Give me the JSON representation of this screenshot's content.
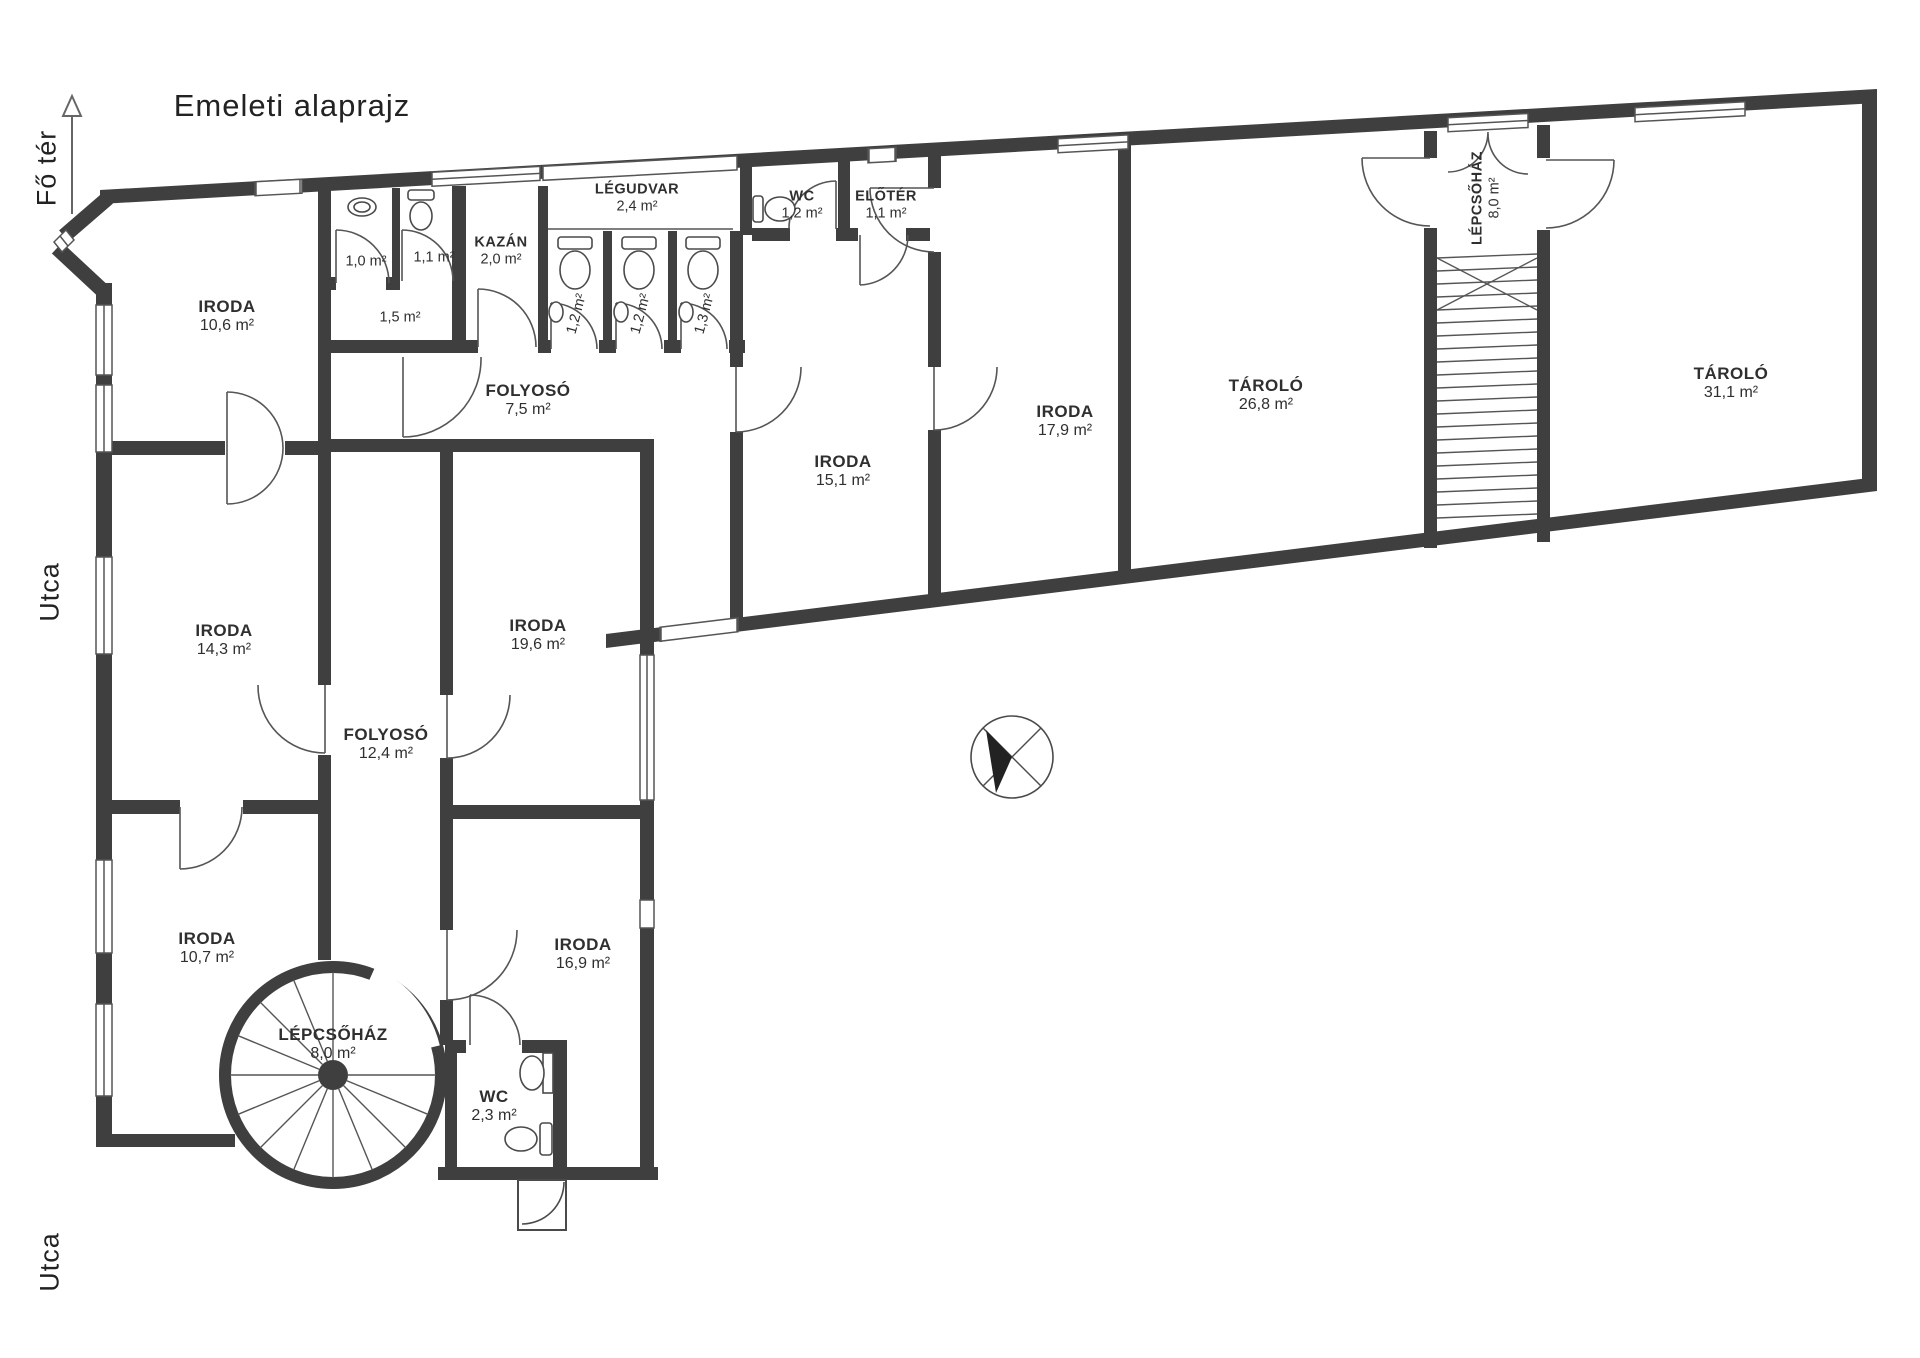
{
  "title": "Emeleti alaprajz",
  "annotations": {
    "fo_ter": "Fő tér",
    "utca_left": "Utca",
    "utca_bottom": "Utca"
  },
  "colors": {
    "wall": "#3f3f3f",
    "line": "#555555",
    "text": "#2a2a2a",
    "bg": "#ffffff"
  },
  "icons": [
    "north-compass-icon",
    "direction-arrow-icon",
    "toilet-icon",
    "sink-icon",
    "spiral-stair-icon",
    "straight-stair-icon",
    "door-swing-icon",
    "window-icon"
  ],
  "rooms": [
    {
      "name": "IRODA",
      "area": "10,6 m²",
      "x": 227,
      "y": 316,
      "rot": 0,
      "small": false
    },
    {
      "name": "",
      "area": "1,0 m²",
      "x": 366,
      "y": 262,
      "rot": 0,
      "small": true
    },
    {
      "name": "",
      "area": "1,1 m²",
      "x": 434,
      "y": 258,
      "rot": 0,
      "small": true
    },
    {
      "name": "",
      "area": "1,5 m²",
      "x": 400,
      "y": 318,
      "rot": 0,
      "small": true
    },
    {
      "name": "KAZÁN",
      "area": "2,0 m²",
      "x": 501,
      "y": 251,
      "rot": 0,
      "small": true
    },
    {
      "name": "LÉGUDVAR",
      "area": "2,4 m²",
      "x": 637,
      "y": 198,
      "rot": 0,
      "small": true
    },
    {
      "name": "WC",
      "area": "1,2 m²",
      "x": 802,
      "y": 205,
      "rot": 0,
      "small": true
    },
    {
      "name": "ELŐTÉR",
      "area": "1,1 m²",
      "x": 886,
      "y": 205,
      "rot": 0,
      "small": true
    },
    {
      "name": "",
      "area": "1,2 m²",
      "x": 577,
      "y": 314,
      "rot": -75,
      "small": true
    },
    {
      "name": "",
      "area": "1,2 m²",
      "x": 641,
      "y": 314,
      "rot": -75,
      "small": true
    },
    {
      "name": "",
      "area": "1,3 m²",
      "x": 705,
      "y": 314,
      "rot": -75,
      "small": true
    },
    {
      "name": "FOLYOSÓ",
      "area": "7,5 m²",
      "x": 528,
      "y": 400,
      "rot": 0,
      "small": false
    },
    {
      "name": "IRODA",
      "area": "15,1 m²",
      "x": 843,
      "y": 471,
      "rot": 0,
      "small": false
    },
    {
      "name": "IRODA",
      "area": "17,9 m²",
      "x": 1065,
      "y": 421,
      "rot": 0,
      "small": false
    },
    {
      "name": "TÁROLÓ",
      "area": "26,8 m²",
      "x": 1266,
      "y": 395,
      "rot": 0,
      "small": false
    },
    {
      "name": "LÉPCSŐHÁZ",
      "area": "8,0 m²",
      "x": 1486,
      "y": 198,
      "rot": -90,
      "small": true
    },
    {
      "name": "TÁROLÓ",
      "area": "31,1 m²",
      "x": 1731,
      "y": 383,
      "rot": 0,
      "small": false
    },
    {
      "name": "IRODA",
      "area": "14,3 m²",
      "x": 224,
      "y": 640,
      "rot": 0,
      "small": false
    },
    {
      "name": "FOLYOSÓ",
      "area": "12,4 m²",
      "x": 386,
      "y": 744,
      "rot": 0,
      "small": false
    },
    {
      "name": "IRODA",
      "area": "19,6 m²",
      "x": 538,
      "y": 635,
      "rot": 0,
      "small": false
    },
    {
      "name": "IRODA",
      "area": "10,7 m²",
      "x": 207,
      "y": 948,
      "rot": 0,
      "small": false
    },
    {
      "name": "IRODA",
      "area": "16,9 m²",
      "x": 583,
      "y": 954,
      "rot": 0,
      "small": false
    },
    {
      "name": "LÉPCSŐHÁZ",
      "area": "8,0 m²",
      "x": 333,
      "y": 1044,
      "rot": 0,
      "small": false
    },
    {
      "name": "WC",
      "area": "2,3 m²",
      "x": 494,
      "y": 1106,
      "rot": 0,
      "small": false
    }
  ]
}
